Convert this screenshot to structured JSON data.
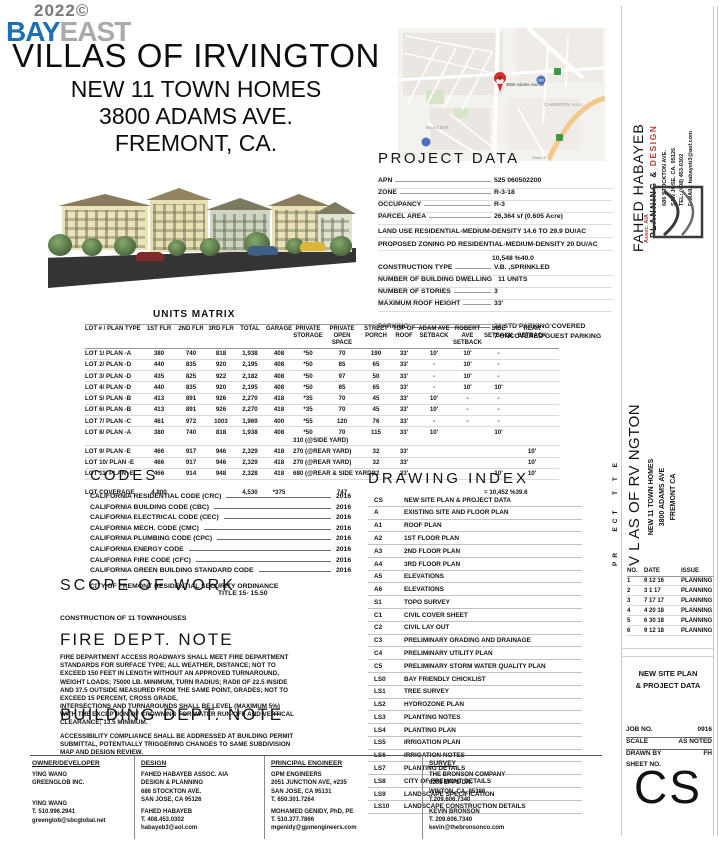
{
  "logo": {
    "year": "2022©",
    "bay": "BAY",
    "east": "EAST"
  },
  "title": {
    "line1": "VILLAS OF IRVINGTON",
    "line2": "NEW 11 TOWN HOMES",
    "line3": "3800 ADAMS AVE.",
    "line4": "FREMONT, CA."
  },
  "map": {
    "pin_label": "3800 Adams Avenue",
    "cameron": "CAMERON HILL",
    "blacow": "BLACOW",
    "warm": "Warm S",
    "badge": "680"
  },
  "project_data": {
    "heading": "PROJECT DATA",
    "rows1": [
      {
        "l": "APN",
        "v": "525 060502200"
      },
      {
        "l": "ZONE",
        "v": "R-3-18"
      },
      {
        "l": "OCCUPANCY",
        "v": "R-3"
      },
      {
        "l": "PARCEL  AREA",
        "v": "26,364 sf (0.605 Acre)"
      }
    ],
    "land_use": "LAND USE RESIDENTIAL-MEDIUM-DENSITY 14.6 TO 29.9 DU/AC",
    "proposed_zoning": "PROPOSED ZONING PD RESIDENTIAL-MEDIUM-DENSITY 20 DU/AC",
    "coverage": "10,548 %40.0",
    "rows2": [
      {
        "l": "CONSTRUCTION TYPE",
        "v": "V.B. ,SPRINKLED"
      },
      {
        "l": "NUMBER OF BUILDING DWELLING",
        "v": "11 UNITS"
      },
      {
        "l": "NUMBER  OF  STORIES",
        "v": "3"
      },
      {
        "l": "MAXIMUM ROOF HEIGHT",
        "v": "33'"
      }
    ],
    "parking_label": "PARKING",
    "parking_value": "22 STD PARKING COVERED\n7 UNCOVERED GUEST PARKING"
  },
  "units_matrix": {
    "heading": "UNITS MATRIX",
    "columns": [
      "LOT # / PLAN TYPE",
      "1ST FLR",
      "2ND FLR",
      "3RD FLR",
      "TOTAL",
      "GARAGE",
      "PRIVATE\nSTORAGE",
      "PRIVATE\nOPEN SPACE",
      "STREET\nPORCH",
      "TOP OF\nROOF",
      "ADAM AVE\nSETBACK",
      "ROBERT AVE\nSETBACK",
      "SIDE\nSETBACK",
      "REAR\nSETBACK"
    ],
    "rows": [
      [
        "LOT 1/  PLAN -A",
        "380",
        "740",
        "818",
        "1,938",
        "408",
        "*50",
        "70",
        "190",
        "33'",
        "10'",
        "10'",
        "-",
        ""
      ],
      [
        "LOT 2/  PLAN -D",
        "440",
        "835",
        "920",
        "2,195",
        "408",
        "*50",
        "85",
        "65",
        "33'",
        "-",
        "10'",
        "-",
        ""
      ],
      [
        "LOT 3/  PLAN -D",
        "435",
        "825",
        "922",
        "2,182",
        "408",
        "*50",
        "97",
        "50",
        "33'",
        "-",
        "10'",
        "-",
        ""
      ],
      [
        "LOT 4/  PLAN -D",
        "440",
        "835",
        "920",
        "2,195",
        "408",
        "*50",
        "85",
        "65",
        "33'",
        "-",
        "10'",
        "10'",
        ""
      ],
      [
        "LOT 5/  PLAN -B",
        "413",
        "891",
        "926",
        "2,270",
        "418",
        "*35",
        "70",
        "45",
        "33'",
        "10'",
        "-",
        "-",
        ""
      ],
      [
        "LOT 6/  PLAN -B",
        "413",
        "891",
        "926",
        "2,270",
        "418",
        "*35",
        "70",
        "45",
        "33'",
        "10'",
        "-",
        "-",
        ""
      ],
      [
        "LOT 7/  PLAN -C",
        "461",
        "972",
        "1003",
        "1,969",
        "400",
        "*55",
        "120",
        "76",
        "33'",
        "-",
        "-",
        "-",
        ""
      ],
      [
        "LOT 8/  PLAN -A",
        "380",
        "740",
        "818",
        "1,938",
        "408",
        "*50\n310 (@SIDE YARD)",
        "70",
        "115",
        "33'",
        "10'",
        "",
        "10'",
        ""
      ],
      [
        "LOT 9/  PLAN -E",
        "466",
        "917",
        "946",
        "2,329",
        "418",
        "270 (@REAR YARD)",
        "",
        "32",
        "33'",
        "",
        "",
        "",
        "10'"
      ],
      [
        "LOT 10/ PLAN -E",
        "466",
        "917",
        "946",
        "2,329",
        "418",
        "270 (@REAR YARD)",
        "",
        "32",
        "33'",
        "",
        "",
        "",
        "10'"
      ],
      [
        "LOT 11/ PLAN -E",
        "466",
        "914",
        "948",
        "2,328",
        "418",
        "680 (@REAR & SIDE YARD)",
        "",
        "32",
        "33'",
        "",
        "",
        "10'",
        "10'"
      ]
    ],
    "coverage_rows": [
      [
        "LOT COVERAGE",
        "4,800",
        "",
        "",
        "4,530",
        "*375",
        "",
        "747",
        "",
        "",
        "",
        "",
        "= 10,452 %39.6",
        ""
      ]
    ]
  },
  "codes": {
    "heading": "CODES",
    "items": [
      [
        "CALIFORNIA RESIDENTIAL CODE (CRC)",
        "2016"
      ],
      [
        "CALIFORNIA BUILDING CODE (CBC)",
        "2016"
      ],
      [
        "CALIFORNIA ELECTRICAL CODE (CEC)",
        "2016"
      ],
      [
        "CALIFORNIA MECH. CODE (CMC)",
        "2016"
      ],
      [
        "CALIFORNIA PLUMBING CODE (CPC)",
        "2016"
      ],
      [
        "CALIFORNIA ENERGY CODE",
        "2016"
      ],
      [
        "CALIFORNIA FIRE CODE (CFC)",
        "2016"
      ],
      [
        "CALIFORNIA GREEN BUILDING STANDARD CODE",
        "2016"
      ]
    ],
    "security1": "CITY OF FREMONT RESIDENTIAL SECURITY ORDINANCE",
    "security2": "TITLE 15- 15.50"
  },
  "scope": {
    "heading": "SCOPE OF WORK",
    "body": "CONSTRUCTION OF 11 TOWNHOUSES"
  },
  "fire_note": {
    "heading": "FIRE DEPT. NOTE",
    "body": "FIRE DEPARTMENT ACCESS ROADWAYS SHALL MEET FIRE DEPARTMENT\nSTANDARDS FOR SURFACE TYPE; ALL WEATHER, DISTANCE; NOT TO\nEXCEED 150 FEET IN LENGTH WITHOUT AN APPROVED TURNAROUND,\nWEIGHT LOADS; 75000 LB. MINIMUM, TURN RADIUS; RADII OF 22.5 INSIDE\nAND 37.5 OUTSIDE MEASURED FROM THE SAME POINT, GRADES; NOT TO\nEXCEED 15 PERCENT, CROSS GRADE,\nINTERSECTIONS AND TURNAROUNDS SHALL BE LEVEL (MAXIMUM 5%)\nWITH THE EXCEPTION OF CROWNING FOR WATER RUN-OFF AND VERTICAL\nCLEARANCE; 13.5 MINIMUM."
  },
  "building_note": {
    "heading": "BUILDING DEPT. NOTE",
    "body": "ACCESSIBILITY COMPLIANCE SHALL BE ADDRESSED AT BUILDING PERMIT\nSUBMITTAL, POTENTIALLY TRIGGERING CHANGES TO SAME SUBDIVISION\nMAP AND DESIGN REVIEW."
  },
  "drawing_index": {
    "heading": "DRAWING INDEX",
    "rows": [
      [
        "CS",
        "NEW SITE PLAN & PROJECT DATA"
      ],
      [
        "A",
        "EXISTING SITE AND FLOOR PLAN"
      ],
      [
        "A1",
        "ROOF PLAN"
      ],
      [
        "A2",
        "1ST FLOOR PLAN"
      ],
      [
        "A3",
        "2ND FLOOR PLAN"
      ],
      [
        "A4",
        "3RD FLOOR PLAN"
      ],
      [
        "A5",
        "ELEVATIONS"
      ],
      [
        "A6",
        "ELEVATIONS"
      ],
      [
        "S1",
        "TOPO SURVEY"
      ],
      [
        "C1",
        "CIVIL COVER SHEET"
      ],
      [
        "C2",
        "CIVIL LAY OUT"
      ],
      [
        "C3",
        "PRELIMINARY GRADING AND DRAINAGE"
      ],
      [
        "C4",
        "PRELIMINARY UTILITY PLAN"
      ],
      [
        "C5",
        "PRELIMINARY STORM WATER QUALITY PLAN"
      ],
      [
        "LS0",
        "BAY FRIENDLY CHICKLIST"
      ],
      [
        "LS1",
        "TREE SURVEY"
      ],
      [
        "LS2",
        "HYDROZONE PLAN"
      ],
      [
        "LS3",
        "PLANTING NOTES"
      ],
      [
        "LS4",
        "PLANTING PLAN"
      ],
      [
        "LS5",
        "IRRIGATION PLAN"
      ],
      [
        "LS6",
        "IRRIGATION NOTES"
      ],
      [
        "LS7",
        "PLANTING DETAILS"
      ],
      [
        "LS8",
        "CITY OF FREMONT DETAILS"
      ],
      [
        "LS9",
        "LANDSCAPE SPECIFICATION"
      ],
      [
        "LS10",
        "LANDSCAPE CONSTRUCTION DETAILS"
      ]
    ]
  },
  "contacts": {
    "columns": [
      {
        "header": "OWNER/DEVELOPER",
        "firm": "YING WANG\nGREENGLOB INC.",
        "person": "YING WANG\nT. 510.996.2941\ngreenglob@sbcglobal.net"
      },
      {
        "header": "DESIGN",
        "firm": "FAHED HABAYEB ASSOC. AIA\nDESIGN & PLANNING\n686 STOCKTON AVE.\nSAN JOSE, CA 95126",
        "person": "FAHED HABAYEB\nT. 408.453.0302\nhabayeb3@aol.com"
      },
      {
        "header": "PRINCIPAL ENGINEER",
        "firm": "GPM ENGINEERS\n2051 JUNCTION AVE, #235\nSAN JOSE, CA 95131\nT. 650.301.7264",
        "person": "MOHAMED GENIDY, PhD, PE\nT. 510.377.7866\nmgenidy@gpmengineers.com"
      },
      {
        "header": "SURVEY",
        "firm": "THE BRONSON COMPANY\n6205 EPPS DR.\nWINTON, CA. 95388\nT.209.606.7340",
        "person": "KEVIN BRONSON\nT. 209.606.7340\nkevin@thebronsonco.com"
      }
    ]
  },
  "titleblock": {
    "firm": {
      "name": "FAHED HABAYEB",
      "tagline1": "PLANNING & ",
      "tagline2": "DESIGN",
      "address": "686 STOCKTON AVE.\nSAN JOSE, CA. 95126\nTEL: (408) 453-0302\nE-MAIL: habayeb3@aol.com",
      "assoc": "Assoc. AIA"
    },
    "project": {
      "label": "PR   ECT  T T E",
      "name": "V L AS OF RV NGTON",
      "sub": "NEW 11 TOWN HOMES\n3800 ADAMS AVE\nFREMONT  CA"
    },
    "revisions": {
      "h1": "NO.",
      "h2": "DATE",
      "h3": "ISSUE",
      "rows": [
        [
          "1",
          "9 12 16",
          "PLANNING"
        ],
        [
          "2",
          "3 1 17",
          "PLANNING"
        ],
        [
          "3",
          "7 17 17",
          "PLANNING"
        ],
        [
          "4",
          "4 20 18",
          "PLANNING"
        ],
        [
          "5",
          "6 30 18",
          "PLANNING"
        ],
        [
          "6",
          "9 12 18",
          "PLANNING"
        ]
      ]
    },
    "sheet_title": "NEW SITE PLAN\n& PROJECT DATA",
    "info": [
      {
        "l": "JOB NO.",
        "v": "0916"
      },
      {
        "l": "SCALE",
        "v": "AS NOTED"
      },
      {
        "l": "DRAWN BY",
        "v": "FH"
      },
      {
        "l": "SHEET NO.",
        "v": ""
      }
    ],
    "sheet_number": "CS"
  }
}
